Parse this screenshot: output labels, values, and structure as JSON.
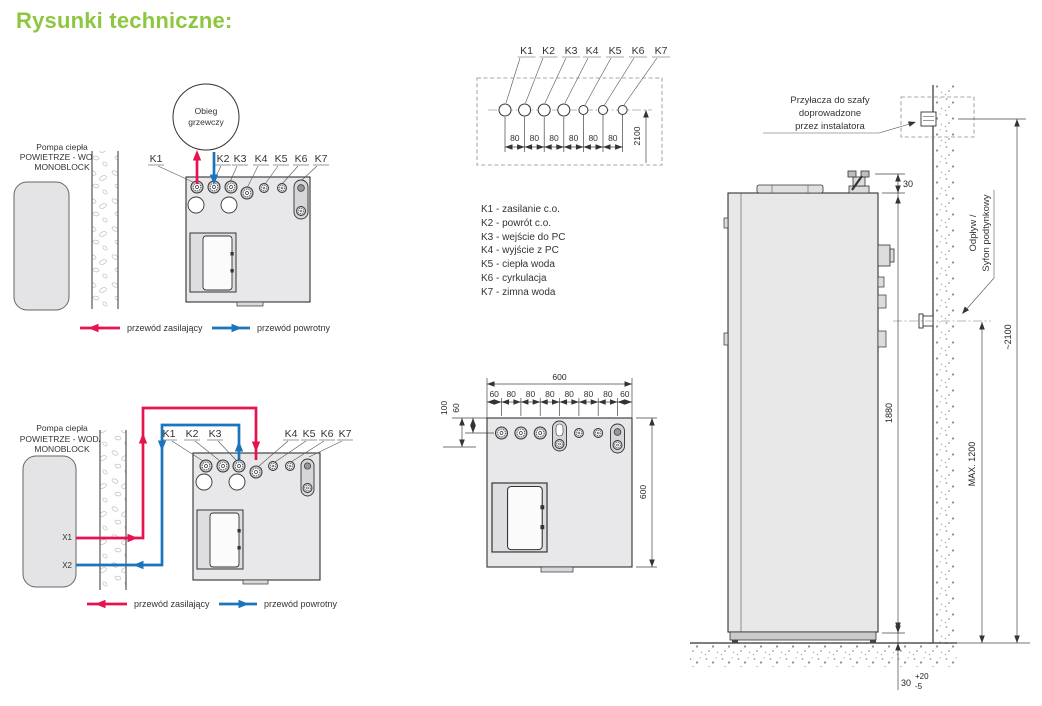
{
  "page": {
    "title": "Rysunki techniczne:"
  },
  "colors": {
    "accent_green": "#8dc63f",
    "supply_red": "#e5134f",
    "return_blue": "#1b75bc",
    "unit_fill": "#e8e8ea",
    "line": "#333333"
  },
  "diagram1": {
    "pump_label": [
      "Pompa ciepła",
      "POWIETRZE - WODA",
      "MONOBLOCK"
    ],
    "circuit_label": [
      "Obieg",
      "grzewczy"
    ],
    "k_labels": [
      "K1",
      "K2",
      "K3",
      "K4",
      "K5",
      "K6",
      "K7"
    ],
    "legend": {
      "supply": "przewód zasilający",
      "return": "przewód powrotny"
    }
  },
  "diagram2": {
    "pump_label": [
      "Pompa ciepła",
      "POWIETRZE - WODA",
      "MONOBLOCK"
    ],
    "x_labels": [
      "X1",
      "X2"
    ],
    "k_labels": [
      "K1",
      "K2",
      "K3",
      "K4",
      "K5",
      "K6",
      "K7"
    ],
    "legend": {
      "supply": "przewód zasilający",
      "return": "przewód powrotny"
    }
  },
  "top_view": {
    "k_labels": [
      "K1",
      "K2",
      "K3",
      "K4",
      "K5",
      "K6",
      "K7"
    ],
    "spacing_labels": [
      "80",
      "80",
      "80",
      "80",
      "80",
      "80"
    ],
    "height_dim": "2100"
  },
  "connection_legend": [
    "K1 - zasilanie c.o.",
    "K2 - powrót c.o.",
    "K3 - wejście do PC",
    "K4 - wyjście z PC",
    "K5 - ciepła woda",
    "K6 - cyrkulacja",
    "K7 - zimna woda"
  ],
  "bottom_view": {
    "width_total": "600",
    "segments": [
      "60",
      "80",
      "80",
      "80",
      "80",
      "80",
      "80",
      "60"
    ],
    "offset_100": "100",
    "offset_60": "60",
    "depth_total": "600"
  },
  "side_view": {
    "note": [
      "Przyłacza do szafy",
      "doprowadzone",
      "przez instalatora"
    ],
    "drain_label": [
      "Odpływ /",
      "Syfon podtynkowy"
    ],
    "dim_top_clearance": "30",
    "dim_height": "1880",
    "dim_wall": "~2100",
    "dim_drain_max": "MAX. 1200",
    "dim_feet": "30",
    "dim_feet_tol_plus": "+20",
    "dim_feet_tol_minus": "-5"
  }
}
